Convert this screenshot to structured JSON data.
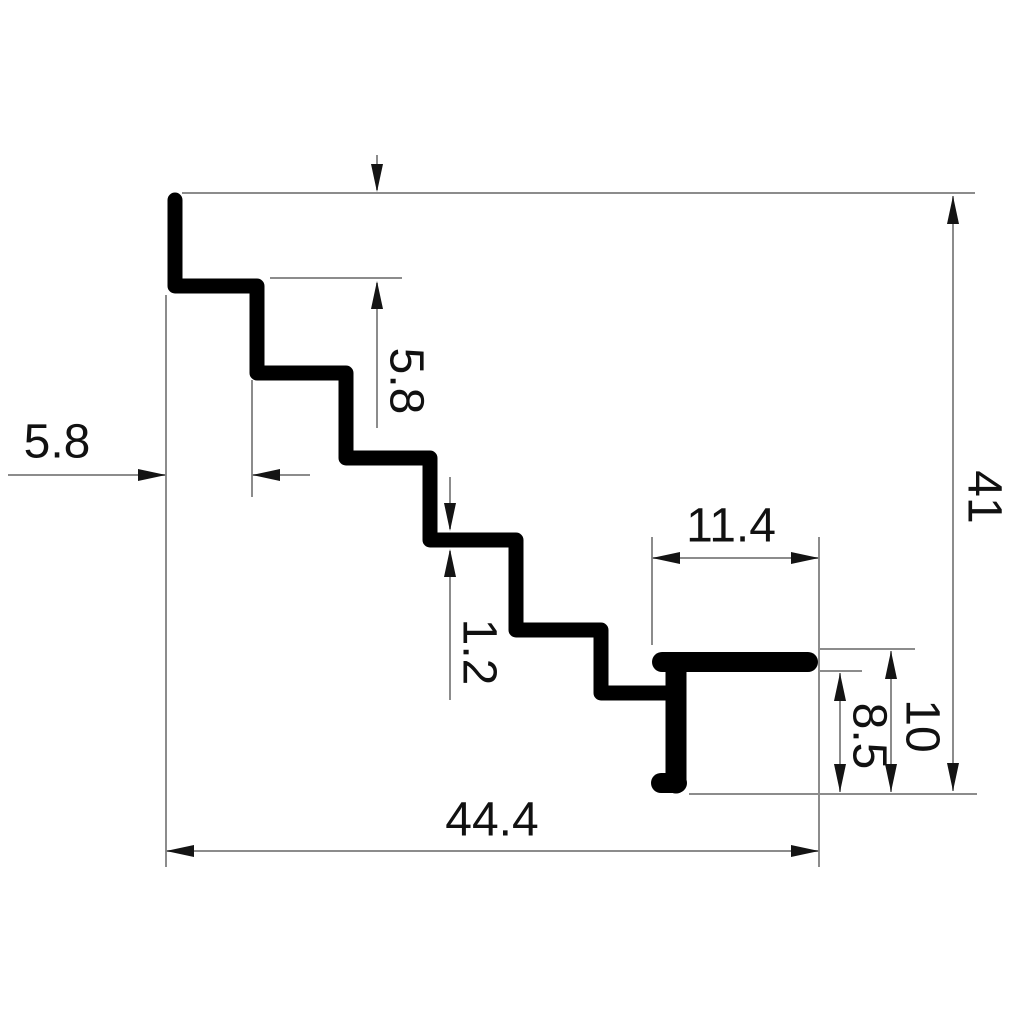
{
  "drawing": {
    "title": "Stair nosing extrusion profile cross-section, dimensioned",
    "canvas": {
      "width": 1024,
      "height": 1024
    },
    "colors": {
      "background": "#ffffff",
      "profile": "#000000",
      "dim_line": "#8c8c8c",
      "arrow": "#141414",
      "text": "#111111"
    },
    "font_size_px": 48,
    "arrow": {
      "length": 28,
      "width": 12
    },
    "labels": [
      {
        "id": "step-depth",
        "text": "5.8",
        "x": 57,
        "y": 442,
        "rotate": 0
      },
      {
        "id": "step-rise",
        "text": "5.8",
        "x": 406,
        "y": 381,
        "rotate": 90
      },
      {
        "id": "wall-thickness",
        "text": "1.2",
        "x": 479,
        "y": 652,
        "rotate": 90
      },
      {
        "id": "flange-width",
        "text": "11.4",
        "x": 731,
        "y": 526,
        "rotate": 0
      },
      {
        "id": "total-height",
        "text": "41",
        "x": 984,
        "y": 497,
        "rotate": 90
      },
      {
        "id": "end-height",
        "text": "10",
        "x": 922,
        "y": 726,
        "rotate": 90
      },
      {
        "id": "stem-height",
        "text": "8.5",
        "x": 869,
        "y": 736,
        "rotate": 90
      },
      {
        "id": "total-width",
        "text": "44.4",
        "x": 492,
        "y": 820,
        "rotate": 0
      }
    ],
    "profile_paths": [
      {
        "id": "staircase",
        "stroke_width": 15,
        "points": [
          [
            175,
            200
          ],
          [
            175,
            286
          ],
          [
            257,
            286
          ],
          [
            257,
            373
          ],
          [
            346,
            373
          ],
          [
            346,
            458
          ],
          [
            430,
            458
          ],
          [
            430,
            540
          ],
          [
            516,
            540
          ],
          [
            516,
            630
          ],
          [
            601,
            630
          ],
          [
            601,
            693
          ],
          [
            667,
            693
          ]
        ]
      },
      {
        "id": "flange",
        "stroke_width": 20,
        "points": [
          [
            662,
            662
          ],
          [
            808,
            662
          ]
        ]
      },
      {
        "id": "stem",
        "stroke_width": 21,
        "points": [
          [
            676,
            664
          ],
          [
            676,
            783
          ]
        ]
      },
      {
        "id": "foot",
        "stroke_width": 20,
        "points": [
          [
            661,
            783
          ],
          [
            677,
            783
          ]
        ]
      }
    ],
    "thin_lines": [
      {
        "id": "top-extension",
        "x1": 182,
        "y1": 193,
        "x2": 975,
        "y2": 193
      },
      {
        "id": "step2-top-extension",
        "x1": 270,
        "y1": 278,
        "x2": 402,
        "y2": 278
      },
      {
        "id": "left-extension",
        "x1": 166,
        "y1": 295,
        "x2": 166,
        "y2": 867
      },
      {
        "id": "step2-left-extension",
        "x1": 252,
        "y1": 380,
        "x2": 252,
        "y2": 497
      },
      {
        "id": "depth-dim-line",
        "x1": 8,
        "y1": 475,
        "x2": 166,
        "y2": 475
      },
      {
        "id": "depth-dim-tail",
        "x1": 252,
        "y1": 475,
        "x2": 310,
        "y2": 475
      },
      {
        "id": "rise-dim-upper-tail",
        "x1": 377,
        "y1": 155,
        "x2": 377,
        "y2": 190
      },
      {
        "id": "rise-dim-lower-tail",
        "x1": 377,
        "y1": 283,
        "x2": 377,
        "y2": 428
      },
      {
        "id": "thickness-upper-tail",
        "x1": 450,
        "y1": 477,
        "x2": 450,
        "y2": 529
      },
      {
        "id": "thickness-lower-tail",
        "x1": 450,
        "y1": 551,
        "x2": 450,
        "y2": 700
      },
      {
        "id": "flange-left-extension",
        "x1": 652,
        "y1": 537,
        "x2": 652,
        "y2": 645
      },
      {
        "id": "right-extension",
        "x1": 819,
        "y1": 537,
        "x2": 819,
        "y2": 867
      },
      {
        "id": "flange-width-dim-line",
        "x1": 652,
        "y1": 558,
        "x2": 819,
        "y2": 558
      },
      {
        "id": "bottom-right-extension",
        "x1": 689,
        "y1": 794,
        "x2": 977,
        "y2": 794
      },
      {
        "id": "flange-top-extension",
        "x1": 818,
        "y1": 649,
        "x2": 915,
        "y2": 649
      },
      {
        "id": "flange-bottom-extension",
        "x1": 818,
        "y1": 671,
        "x2": 862,
        "y2": 671
      },
      {
        "id": "stem-height-dim-line",
        "x1": 840,
        "y1": 673,
        "x2": 840,
        "y2": 792
      },
      {
        "id": "end-height-dim-line",
        "x1": 891,
        "y1": 651,
        "x2": 891,
        "y2": 792
      },
      {
        "id": "total-height-dim-line",
        "x1": 953,
        "y1": 196,
        "x2": 953,
        "y2": 791
      },
      {
        "id": "total-width-dim-line",
        "x1": 166,
        "y1": 851,
        "x2": 819,
        "y2": 851
      }
    ],
    "arrows": [
      {
        "id": "rise-top",
        "x": 377,
        "y": 192,
        "dir": "down"
      },
      {
        "id": "rise-bottom",
        "x": 377,
        "y": 281,
        "dir": "up"
      },
      {
        "id": "depth-left",
        "x": 166,
        "y": 475,
        "dir": "right"
      },
      {
        "id": "depth-right",
        "x": 252,
        "y": 475,
        "dir": "left"
      },
      {
        "id": "thickness-top",
        "x": 450,
        "y": 531,
        "dir": "down"
      },
      {
        "id": "thickness-bottom",
        "x": 450,
        "y": 549,
        "dir": "up"
      },
      {
        "id": "flange-width-left",
        "x": 652,
        "y": 558,
        "dir": "left"
      },
      {
        "id": "flange-width-right",
        "x": 819,
        "y": 558,
        "dir": "right"
      },
      {
        "id": "stem-height-top",
        "x": 840,
        "y": 673,
        "dir": "up"
      },
      {
        "id": "stem-height-bottom",
        "x": 840,
        "y": 792,
        "dir": "down"
      },
      {
        "id": "end-height-top",
        "x": 891,
        "y": 651,
        "dir": "up"
      },
      {
        "id": "end-height-bottom",
        "x": 891,
        "y": 792,
        "dir": "down"
      },
      {
        "id": "total-height-top",
        "x": 953,
        "y": 196,
        "dir": "up"
      },
      {
        "id": "total-height-bottom",
        "x": 953,
        "y": 791,
        "dir": "down"
      },
      {
        "id": "total-width-left",
        "x": 166,
        "y": 851,
        "dir": "left"
      },
      {
        "id": "total-width-right",
        "x": 819,
        "y": 851,
        "dir": "right"
      }
    ]
  }
}
